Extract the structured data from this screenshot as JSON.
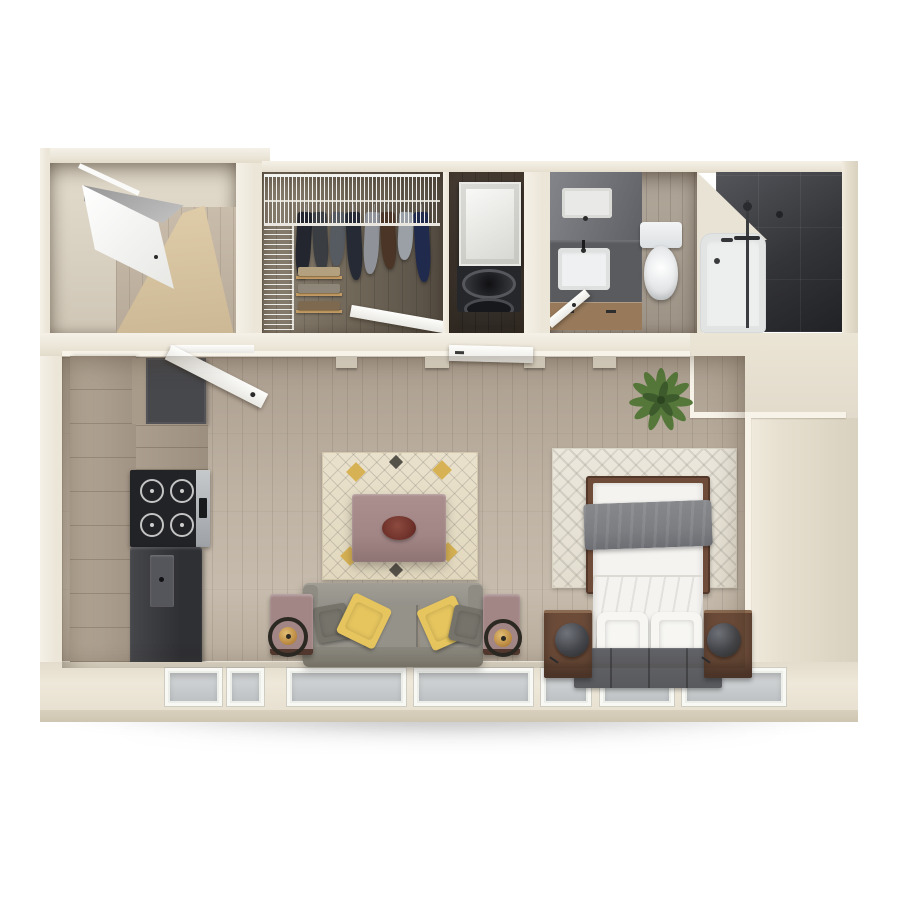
{
  "app": {
    "name": "3d-floor-plan-render",
    "view": "top-down",
    "unit": "studio-apartment"
  },
  "canvas": {
    "width": 900,
    "height": 900,
    "background": "#ffffff"
  },
  "palette": {
    "wall": "#ece6d9",
    "wallLight": "#f5f1e7",
    "wallDark": "#dcd4c3",
    "trim": "#f7f3e9",
    "floorMain": "#b9ac9d",
    "floorEntry": "#d8c5a3",
    "floorCloset": "#75695c",
    "floorLaundry": "#3c352d",
    "floorBath": "#a79d90",
    "showerTile": "#353639",
    "cabinetWood": "#aea193",
    "cabinetDark": "#47484c",
    "applianceDark": "#36373b",
    "applianceSteel": "#b7babd",
    "sofaGray": "#95928a",
    "pillowYellow": "#e6c55e",
    "pillowGray": "#75736a",
    "rugLiving": "#e9e1cc",
    "rugBed": "#ebe7dc",
    "rugGold": "#d7b254",
    "tableMauve": "#a28686",
    "bedFrame": "#6f4b39",
    "beddingWhite": "#f4f3f0",
    "throwGray": "#7c7e82",
    "runnerGray": "#595a5d",
    "nightstand": "#6c4b39",
    "lampDark": "#45474b",
    "plantGreen": "#55783a",
    "plantDark": "#3c5a2b",
    "windowGlass": "#bcc0c2",
    "windowFrame": "#f8f8f5",
    "porcelain": "#eef0f1",
    "tubWhite": "#edefef",
    "vanityCounter": "#595b5f",
    "vanityMirror": "#75777c",
    "vanityWood": "#987a5b",
    "doorWhite": "#fbfbf8",
    "foldedTan": "#b2a07f",
    "foldedGray": "#8e8779",
    "foldedBrown": "#7d6950",
    "shelfWood": "#c09a62",
    "ottomanCenter": "#6b2f28"
  },
  "rooms": [
    {
      "name": "Entry",
      "items": [
        "entry-door",
        "wood-floor"
      ]
    },
    {
      "name": "Walk-in Closet",
      "items": [
        "wire-shelving",
        "hanging-clothes",
        "folded-clothes",
        "closet-door"
      ]
    },
    {
      "name": "Laundry Closet",
      "items": [
        "stacked-washer-dryer",
        "laundry-door"
      ]
    },
    {
      "name": "Bathroom",
      "items": [
        "vanity-with-sink",
        "mirror",
        "toilet",
        "bathtub",
        "walk-in-shower",
        "bathroom-door"
      ]
    },
    {
      "name": "Kitchen",
      "items": [
        "base-cabinets",
        "upper-cabinets",
        "range-cooktop",
        "refrigerator"
      ]
    },
    {
      "name": "Living Area",
      "items": [
        "patterned-area-rug",
        "ottoman-coffee-table",
        "three-seat-sofa",
        "throw-pillows",
        "side-tables",
        "arc-floor-lamps"
      ]
    },
    {
      "name": "Sleeping Area",
      "items": [
        "chevron-area-rug",
        "double-bed",
        "gray-throw-blanket",
        "bed-pillows",
        "nightstands",
        "dome-table-lamps",
        "foot-runner",
        "potted-plant"
      ]
    }
  ],
  "windows": {
    "count": 7,
    "wall": "bottom"
  },
  "closet": {
    "hanging_clothes": [
      {
        "color": "#23262e",
        "height": 66
      },
      {
        "color": "#3a3d42",
        "height": 60
      },
      {
        "color": "#565a61",
        "height": 54
      },
      {
        "color": "#262a34",
        "height": 68
      },
      {
        "color": "#8f9399",
        "height": 62
      },
      {
        "color": "#4a3526",
        "height": 57
      },
      {
        "color": "#9aa0a5",
        "height": 48
      },
      {
        "color": "#202a4c",
        "height": 70
      }
    ]
  }
}
